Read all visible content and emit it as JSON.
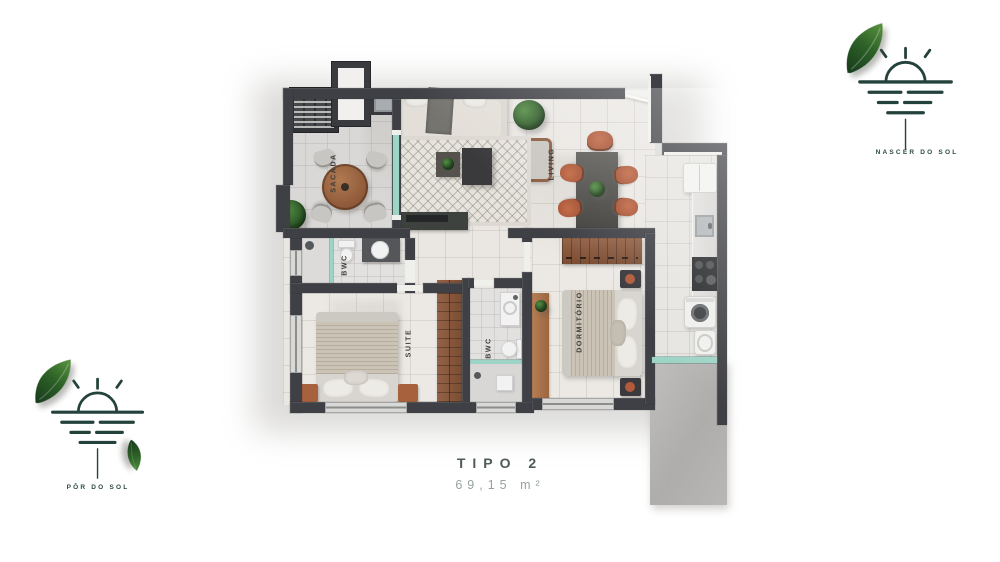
{
  "plan": {
    "rooms": {
      "sacada": {
        "label": "SACADA"
      },
      "living": {
        "label": "LIVING"
      },
      "bwc_suite": {
        "label": "BWC"
      },
      "suite": {
        "label": "SUITE"
      },
      "bwc_social": {
        "label": "BWC"
      },
      "dormitorio": {
        "label": "DORMITÓRIO"
      }
    }
  },
  "caption": {
    "title": "TIPO 2",
    "area": "69,15 m²"
  },
  "logos": {
    "nascer": {
      "label": "NASCER DO SOL"
    },
    "por": {
      "label": "PÔR DO SOL"
    }
  },
  "colors": {
    "wall": "#3f4045",
    "brand_green": "#24423c",
    "terracotta": "#b25a3b",
    "wood": "#8a5c40",
    "glass": "#9ed4c6",
    "title_text": "#4f5b57",
    "area_text": "#97a19d"
  }
}
